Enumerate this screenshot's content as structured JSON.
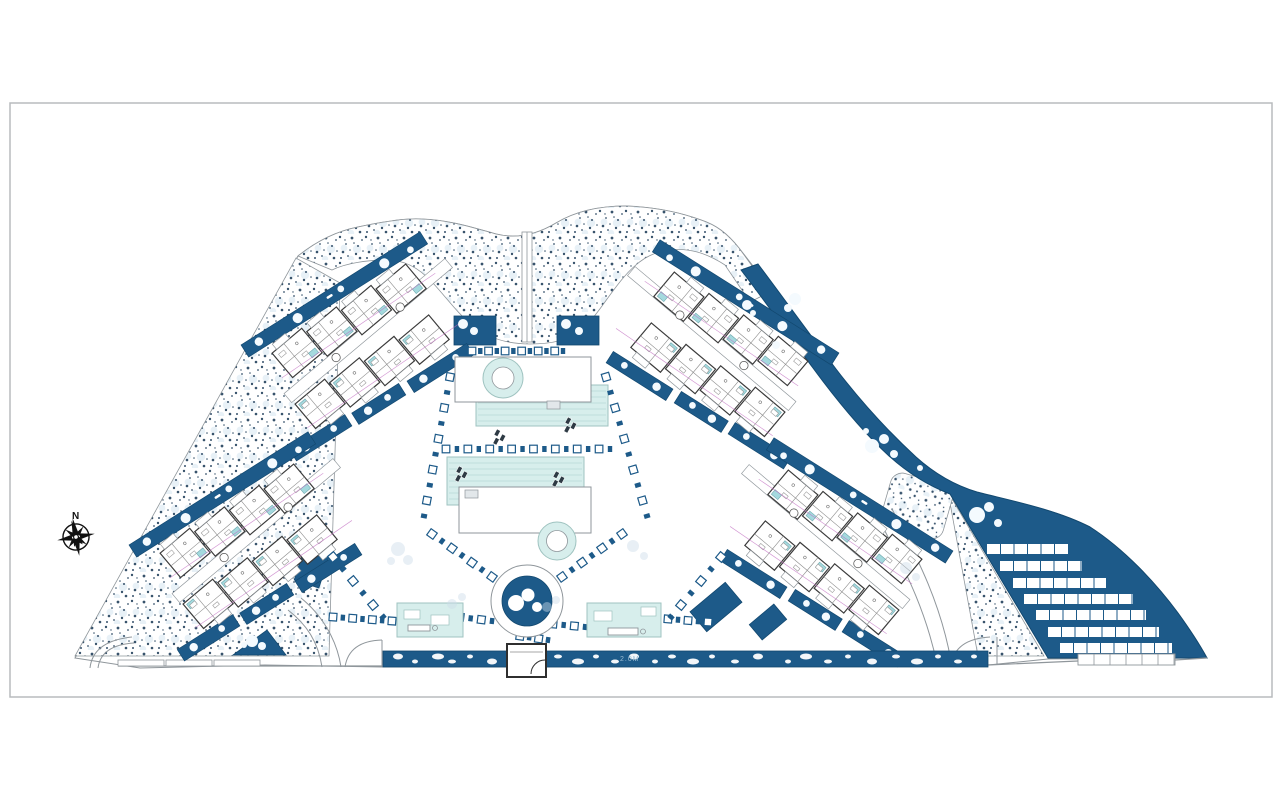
{
  "page": {
    "frame": {
      "x": 10,
      "y": 103,
      "w": 1262,
      "h": 594
    }
  },
  "compass": {
    "label": "N",
    "cx": 76,
    "cy": 537
  },
  "annotation": {
    "label": "2.0M",
    "x": 620,
    "y": 661
  },
  "colors": {
    "white": "#ffffff",
    "navy": "#1d5a89",
    "navy_edge": "#12486f",
    "teal_pool": "#d7eeec",
    "pool_line": "#b7dad6",
    "pool_edge": "#9fc3c0",
    "unit_pool": "#a4d9de",
    "unit_pool_edge": "#6fa8ad",
    "wall": "#3a3a3a",
    "line": "#8f969b",
    "line_soft": "#b5bbc0",
    "inner_line": "#8a8a8a",
    "stipple_dot": "#22405c",
    "stipple_light": "#d9e8f2",
    "frame": "#b8bbbd",
    "magenta": "#c06cc0",
    "tree": "#f4fafe",
    "faint": "#ccdce8",
    "black": "#111111"
  },
  "scene": {
    "silhouette": "M140,668 L75,658 L298,256 C318,240 338,231 358,227 C386,221 406,218 421,219 C449,220 471,227 496,234 C516,239 536,235 556,223 C576,211 601,206 626,206 C654,207 679,212 701,220 C716,225 727,233 739,248 C765,281 795,322 824,360 C853,398 884,430 912,456 C934,476 956,487 977,493 C1008,501 1055,509 1090,527 C1124,549 1155,582 1178,613 C1191,631 1201,647 1207,658 L1048,659 L988,665 L546,667 L383,667 L265,665 Z",
    "stipple_paths": [
      "M75,656 L296,258 L340,283 L329,656 Z",
      "M298,256 C318,240 338,231 358,227 C386,221 406,218 421,219 C449,220 471,227 496,234 C516,239 536,235 556,223 C576,211 601,206 626,206 C654,207 679,212 701,220 C716,225 727,233 739,248 L755,270 L770,292 L750,302 L725,265 C705,252 688,248 670,250 C650,252 637,262 624,277 C610,293 598,314 585,327 C570,341 550,344 530,344 C508,344 488,338 473,326 C458,314 446,297 432,282 C418,267 404,260 388,260 C368,260 346,263 332,270 Z",
      "M948,492 L1044,656 L978,656 Z"
    ],
    "stipple_patch": {
      "x": 885,
      "y": 478,
      "w": 64,
      "h": 56,
      "rx": 12,
      "rot": 16
    },
    "navy_band": "M758,264 C782,296 808,332 836,369 C862,403 890,433 916,457 C936,475 957,486 977,492 C1008,500 1055,509 1090,527 C1124,549 1155,582 1178,613 C1191,631 1201,647 1207,658 L1048,658 L950,494 C929,486 909,474 889,456 C864,433 838,402 813,368 C788,334 762,297 741,270 Z",
    "entry_strip": {
      "x": 383,
      "y": 651,
      "w": 605,
      "h": 16
    },
    "pebbles": [
      [
        398,
        5,
        3
      ],
      [
        415,
        3,
        2
      ],
      [
        438,
        6,
        3
      ],
      [
        452,
        4,
        2
      ],
      [
        470,
        3,
        2
      ],
      [
        492,
        5,
        3
      ],
      [
        558,
        4,
        2
      ],
      [
        578,
        6,
        3
      ],
      [
        596,
        3,
        2
      ],
      [
        615,
        4,
        2
      ],
      [
        634,
        5,
        3
      ],
      [
        655,
        3,
        2
      ],
      [
        672,
        4,
        2
      ],
      [
        693,
        6,
        3
      ],
      [
        712,
        3,
        2
      ],
      [
        735,
        4,
        2
      ],
      [
        758,
        5,
        3
      ],
      [
        788,
        3,
        2
      ],
      [
        806,
        6,
        3
      ],
      [
        828,
        4,
        2
      ],
      [
        848,
        3,
        2
      ],
      [
        872,
        5,
        3
      ],
      [
        896,
        4,
        2
      ],
      [
        917,
        6,
        3
      ],
      [
        938,
        3,
        2
      ],
      [
        958,
        4,
        2
      ],
      [
        974,
        3,
        2
      ]
    ],
    "navy_patches": [
      {
        "x": 454,
        "y": 316,
        "w": 42,
        "h": 29,
        "rot": 0
      },
      {
        "x": 557,
        "y": 316,
        "w": 42,
        "h": 29,
        "rot": 0
      },
      {
        "x": 693,
        "y": 594,
        "w": 46,
        "h": 26,
        "rot": -40
      },
      {
        "x": 300,
        "y": 543,
        "w": 26,
        "h": 42,
        "rot": 18
      },
      {
        "x": 752,
        "y": 612,
        "w": 32,
        "h": 20,
        "rot": -40
      }
    ],
    "navy_triangle": "M233,655 L286,655 L267,630 Z",
    "roads": [
      "M90,668 Q93,641 132,637",
      "M98,668 Q101,645 134,643",
      "M288,610 C306,624 318,641 322,667",
      "M301,598 C322,615 337,640 341,667",
      "M345,667 Q349,641 382,640",
      "M382,640 L382,667",
      "M951,665 Q955,639 990,637",
      "M997,637 L997,665",
      "M879,519 C899,560 924,602 937,664",
      "M892,509 C914,552 940,599 951,661"
    ],
    "wall_lines": [
      "M118,666 L382,666",
      "M988,665 L1078,661 L1175,660 L1207,658"
    ],
    "wall_ticks": [
      [
        118,
        660,
        46,
        6
      ],
      [
        166,
        660,
        46,
        6
      ],
      [
        214,
        660,
        46,
        6
      ]
    ],
    "top_path": {
      "x": 522,
      "y": 232,
      "w": 10,
      "h": 110
    },
    "clusters": [
      {
        "name": "top-left",
        "cx": 374,
        "cy": 340,
        "m": 1
      },
      {
        "name": "bottom-left",
        "cx": 262,
        "cy": 540,
        "m": 1
      },
      {
        "name": "top-right",
        "cx": 706,
        "cy": 348,
        "m": -1
      },
      {
        "name": "bottom-right",
        "cx": 820,
        "cy": 546,
        "m": -1
      }
    ],
    "cluster_scale": 0.84,
    "cluster_rot": -40,
    "pools": {
      "upper": {
        "deck": [
          455,
          357,
          136,
          45
        ],
        "pool": [
          476,
          385,
          132,
          41
        ],
        "ring": [
          503,
          378,
          20,
          11
        ],
        "step": [
          547,
          401,
          13,
          8
        ]
      },
      "lower": {
        "pool": [
          447,
          457,
          137,
          48
        ],
        "deck": [
          459,
          487,
          132,
          46
        ],
        "ring": [
          557,
          541,
          19,
          10.5
        ],
        "step": [
          465,
          490,
          13,
          8
        ]
      }
    },
    "loungers": [
      [
        497,
        429
      ],
      [
        568,
        417
      ],
      [
        459,
        466
      ],
      [
        556,
        471
      ]
    ],
    "chains": [
      [
        472,
        351,
        563,
        351,
        12
      ],
      [
        446,
        449,
        610,
        449,
        16
      ],
      [
        450,
        377,
        424,
        516,
        10
      ],
      [
        606,
        377,
        647,
        516,
        10
      ],
      [
        432,
        534,
        502,
        584,
        8
      ],
      [
        622,
        534,
        552,
        584,
        8
      ],
      [
        333,
        617,
        392,
        621,
        7
      ],
      [
        460,
        617,
        492,
        621,
        4
      ],
      [
        553,
        624,
        585,
        627,
        4
      ],
      [
        668,
        619,
        708,
        622,
        5
      ],
      [
        520,
        636,
        548,
        640,
        4
      ],
      [
        333,
        557,
        383,
        617,
        6
      ],
      [
        721,
        557,
        671,
        617,
        6
      ]
    ],
    "pavilions": [
      {
        "name": "pavilion-left",
        "x": 397,
        "y": 603,
        "w": 66,
        "h": 34,
        "furn": [
          [
            404,
            610,
            16,
            9
          ],
          [
            431,
            615,
            18,
            10
          ]
        ],
        "out": [
          [
            408,
            625,
            22,
            6
          ]
        ]
      },
      {
        "name": "pavilion-right",
        "x": 587,
        "y": 603,
        "w": 74,
        "h": 34,
        "furn": [
          [
            594,
            611,
            18,
            10
          ],
          [
            641,
            607,
            15,
            9
          ]
        ],
        "out": [
          [
            608,
            628,
            30,
            7
          ]
        ]
      }
    ],
    "pond": {
      "cx": 527,
      "cy": 601,
      "r_out": 36,
      "r_in": 25,
      "blobs": [
        [
          516,
          603,
          8
        ],
        [
          528,
          595,
          6.5
        ],
        [
          537,
          607,
          5
        ]
      ]
    },
    "gatehouse": {
      "x": 507,
      "y": 644,
      "w": 39,
      "h": 33,
      "door": "M545,660 A14,14 0 0 0 531,674",
      "line": "M510,652 L543,652"
    },
    "terraces": {
      "rows": [
        [
          987,
          544,
          81
        ],
        [
          1000,
          561,
          82
        ],
        [
          1013,
          578,
          93
        ],
        [
          1024,
          594,
          109
        ],
        [
          1036,
          610,
          110
        ],
        [
          1048,
          627,
          111
        ],
        [
          1060,
          643,
          112
        ]
      ],
      "row_h": 10,
      "seg_w": 13.5,
      "outline_row": [
        1078,
        654,
        97,
        11
      ],
      "outline_seg": 16
    },
    "trees": [
      [
        795,
        299,
        6
      ],
      [
        788,
        308,
        4
      ],
      [
        872,
        446,
        7
      ],
      [
        884,
        439,
        5
      ],
      [
        894,
        454,
        4
      ],
      [
        977,
        515,
        8
      ],
      [
        989,
        507,
        5
      ],
      [
        998,
        523,
        4
      ],
      [
        866,
        431,
        3
      ],
      [
        920,
        468,
        3
      ],
      [
        252,
        641,
        6
      ],
      [
        262,
        646,
        4
      ],
      [
        244,
        645,
        3
      ],
      [
        463,
        324,
        5
      ],
      [
        474,
        331,
        4
      ],
      [
        566,
        324,
        5
      ],
      [
        579,
        331,
        4
      ],
      [
        747,
        305,
        5
      ],
      [
        753,
        313,
        3
      ],
      [
        776,
        345,
        4
      ]
    ],
    "faint_circles": [
      [
        398,
        549,
        7
      ],
      [
        408,
        560,
        5
      ],
      [
        391,
        561,
        4
      ],
      [
        633,
        546,
        6
      ],
      [
        644,
        556,
        4
      ],
      [
        547,
        607,
        5
      ],
      [
        556,
        600,
        4
      ],
      [
        906,
        568,
        6
      ],
      [
        916,
        577,
        4
      ],
      [
        452,
        604,
        5
      ],
      [
        462,
        597,
        4
      ]
    ]
  }
}
